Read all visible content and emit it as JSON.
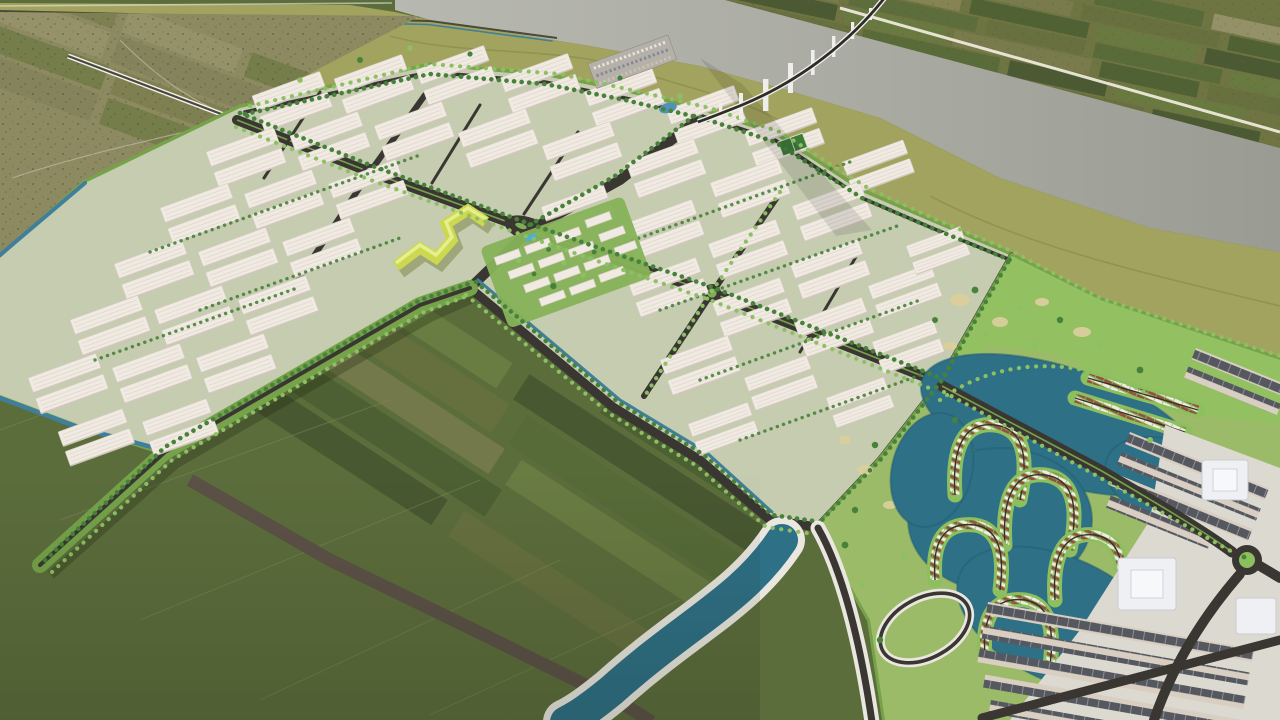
{
  "scene": {
    "type": "aerial-3d-masterplan-render",
    "view": "high oblique bird's-eye view of a planned industrial park and resort township beside a wide river",
    "regions": [
      {
        "name": "river",
        "desc": "wide gray river crossing the top of the image"
      },
      {
        "name": "bridge",
        "desc": "long curved viaduct bridge on white piers crossing the river at top right"
      },
      {
        "name": "far-shore-farmland",
        "desc": "patchwork farmland on the far river bank, top right corner, with white dike road"
      },
      {
        "name": "village-farmland",
        "desc": "olive-toned existing village land at top left with access highway"
      },
      {
        "name": "river-bank",
        "desc": "smooth olive-green levee band between river and development"
      },
      {
        "name": "industrial-park",
        "desc": "large industrial estate of white warehouse blocks in tree-lined grid"
      },
      {
        "name": "warehouses",
        "desc": "rows of white gable-roof factory/warehouse pairs rotated with the grid"
      },
      {
        "name": "zigzag-office-building",
        "desc": "yellow-green zigzag landmark office building at park center-south edge"
      },
      {
        "name": "apartment-district",
        "desc": "cluster of white mid-rise apartment slabs with courtyards and pool"
      },
      {
        "name": "main-avenue",
        "desc": "main boulevard with roundabouts running diagonally through the estate"
      },
      {
        "name": "spine-boulevard",
        "desc": "tree-lined canal boulevard along the south edge of the estate"
      },
      {
        "name": "fields",
        "desc": "large patchwork of green paddy fields in the lower left half"
      },
      {
        "name": "dirt-road",
        "desc": "wide brown dirt road crossing the fields toward bottom center"
      },
      {
        "name": "golf-park",
        "desc": "bright green landscaped park with sand bunkers, middle right"
      },
      {
        "name": "lagoon",
        "desc": "dark teal lagoons of the resort township on the right"
      },
      {
        "name": "villa-clusters",
        "desc": "hairpin peninsulas lined with red-roofed villas in the lagoon"
      },
      {
        "name": "urban-district",
        "desc": "shophouse rows, white landmark buildings, plaza and roundabout at far right"
      },
      {
        "name": "teal-river",
        "desc": "turquoise canal river with white banks curving off the bottom center"
      },
      {
        "name": "roundabouts",
        "count": 4
      }
    ]
  },
  "palette": {
    "field": "#5c6d3c",
    "fieldA": "#4d6033",
    "fieldB": "#697c42",
    "fieldC": "#566b38",
    "fieldD": "#73794a",
    "fieldE": "#485831",
    "fieldF": "#66703f",
    "dirt": "#5c5147",
    "farm": "#8d8a62",
    "farmA": "#7b7d4e",
    "farmB": "#98946c",
    "farmC": "#6e7a45",
    "speck": "#52523c",
    "olive": "#a2a35e",
    "oliveDark": "#8f9150",
    "river": "#a9aaa2",
    "riverL": "#b7b8b0",
    "riverD": "#999b92",
    "bankLine": "#e9e7df",
    "canal": "#3f7f9b",
    "pool": "#4fb0d6",
    "teal": "#2e7086",
    "tealD": "#235e70",
    "parkBase": "#c6ccb0",
    "golfBase": "#9cbb68",
    "golf": "#93c162",
    "green": "#76a24a",
    "green2": "#8cbf5e",
    "tree": "#47823a",
    "treeL": "#8cc063",
    "road": "#3a3733",
    "roadL": "#6a665f",
    "bldg": "#f0eae2",
    "bldgEdge": "#d6cdc2",
    "bldgShade": "#cfc6bb",
    "ridge": "#e2dacf",
    "zigzag": "#ccd84f",
    "zigzagD": "#a8b53a",
    "sand": "#d9cf9b",
    "villaRoof": "#95503e",
    "villaWhite": "#f0eae3",
    "shopRoof": "#565860",
    "shopBody": "#d8cec2",
    "plaza": "#dcd9d1",
    "monument": "#eef0f3",
    "monuShade": "#c9cbd1",
    "bridge": "#efeeea",
    "bridgeRoad": "#2f2c28"
  }
}
